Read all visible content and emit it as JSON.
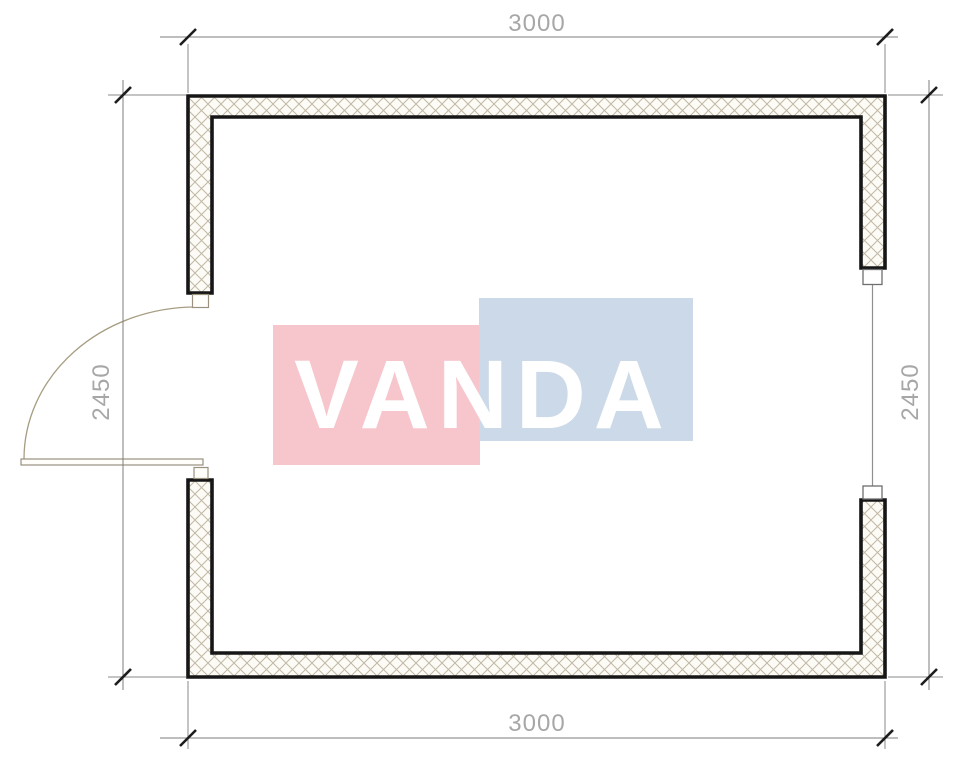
{
  "watermark": {
    "text": "VANDA",
    "pink_color": "#f7c6cd",
    "blue_color": "#ccd9e8",
    "text_color": "#ffffff"
  },
  "dimensions": {
    "top": "3000",
    "bottom": "3000",
    "left": "2450",
    "right": "2450"
  },
  "colors": {
    "wall_outline": "#161616",
    "wall_hatch": "#c1b8a5",
    "dimension_line": "#7e7e7e",
    "dimension_text": "#a7a7a7",
    "door_swing": "#a79d83"
  }
}
